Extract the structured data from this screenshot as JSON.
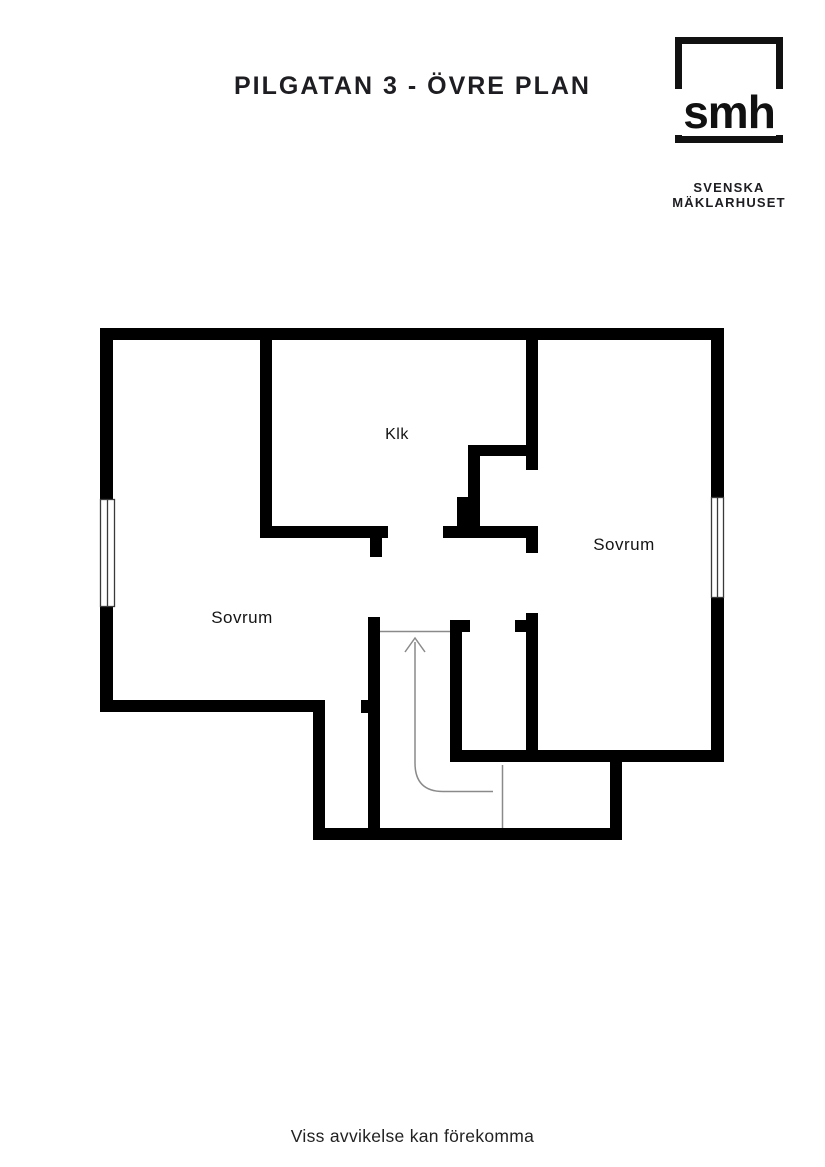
{
  "header": {
    "title": "PILGATAN 3 - ÖVRE PLAN"
  },
  "logo": {
    "monogram": "smh",
    "line1": "SVENSKA",
    "line2": "MÄKLARHUSET"
  },
  "floorplan": {
    "rooms": [
      {
        "id": "klk",
        "label": "Klk"
      },
      {
        "id": "sovrum-right",
        "label": "Sovrum"
      },
      {
        "id": "sovrum-left",
        "label": "Sovrum"
      }
    ],
    "stairs_direction": "up"
  },
  "footer": {
    "disclaimer": "Viss avvikelse kan förekomma"
  },
  "colors": {
    "wall": "#000000",
    "stair_line": "#8a8a8a",
    "window_frame": "#3a3a3a",
    "text": "#1d1d22",
    "background": "#ffffff"
  }
}
